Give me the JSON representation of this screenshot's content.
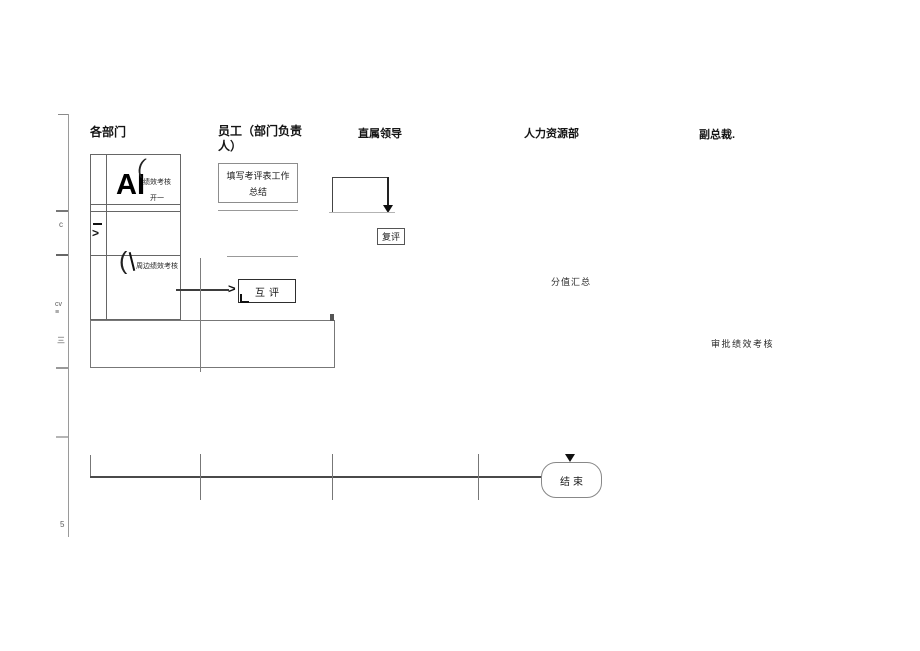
{
  "colors": {
    "background": "#ffffff",
    "line": "#8a8a8a",
    "line_dark": "#333333",
    "text": "#1a1a1a"
  },
  "lanes": {
    "departments": "各部门",
    "employee": "员工（部门负责人）",
    "direct_leader": "直属领导",
    "hr": "人力资源部",
    "vice_president": "副总裁."
  },
  "ruler_marks": [
    "c",
    "cv",
    "≡",
    "三",
    "5"
  ],
  "dept_box": {
    "ai_text": "AI",
    "pen_stroke_1": "(",
    "perf_review": "绩效考核",
    "kai_fragment": "开一",
    "chevron": ">",
    "pen_stroke_2": "(",
    "peripheral_review": "周边绩效考核"
  },
  "flow": {
    "fill_form": "填写考评表工作总结",
    "re_review": "复评",
    "mutual_review": "互评",
    "mutual_arrow": ">",
    "score_summary": "分值汇总",
    "approve_review": "审批绩效考核",
    "end": "结束"
  }
}
